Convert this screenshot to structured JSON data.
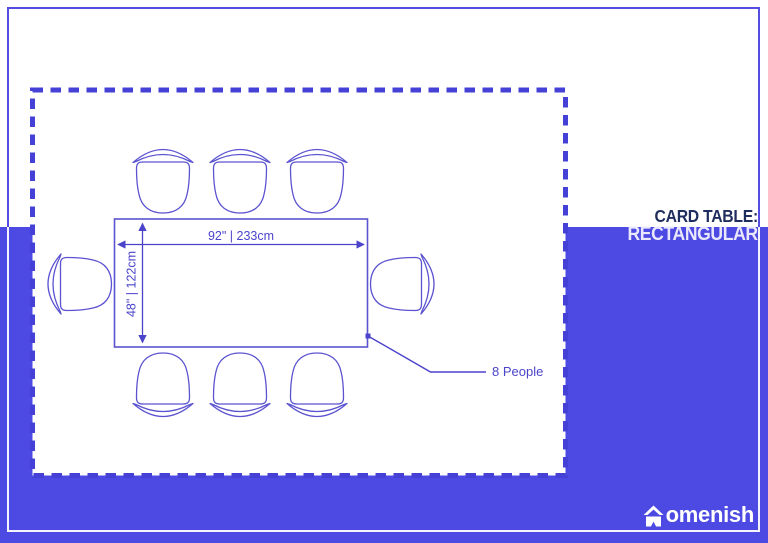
{
  "title": {
    "line1": "CARD TABLE:",
    "line2": "RECTANGULAR"
  },
  "diagram": {
    "type": "furniture-dimension-floorplan",
    "table_shape": "rectangular",
    "width_label": "92\" | 233cm",
    "height_label": "48\" | 122cm",
    "capacity_label": "8 People",
    "chair_count": 8,
    "chair_layout": {
      "top": 3,
      "bottom": 3,
      "left": 1,
      "right": 1
    }
  },
  "logo": {
    "name": "Homenish",
    "wordmark": "omenish",
    "icon": "house-icon"
  },
  "colors": {
    "background": "#ffffff",
    "band_blue": "#4c4ae2",
    "dash_blue": "#4540d6",
    "line_blue": "#5b53cf",
    "dimension_blue": "#4b44cb",
    "title_navy": "#1f2d5e",
    "title_white": "#eae8fc",
    "logo_white": "#ffffff"
  }
}
